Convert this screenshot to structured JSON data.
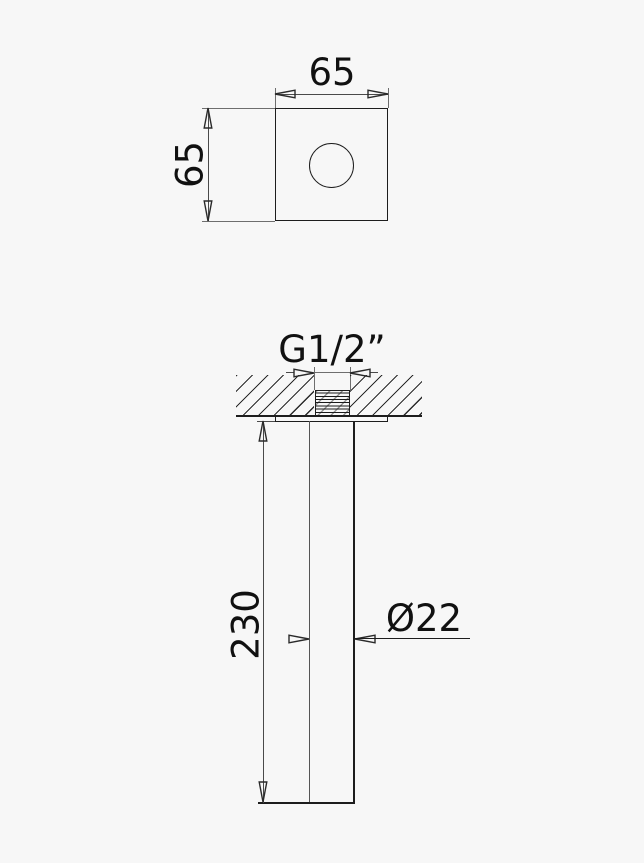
{
  "colors": {
    "background": "#f7f7f7",
    "object_line": "#1d1d1d",
    "dimension_line": "#4a4a4a"
  },
  "top_view": {
    "width_label": "65",
    "height_label": "65"
  },
  "front_view": {
    "thread_label": "G1/2”",
    "length_label": "230",
    "diameter_label": "Ø22"
  }
}
